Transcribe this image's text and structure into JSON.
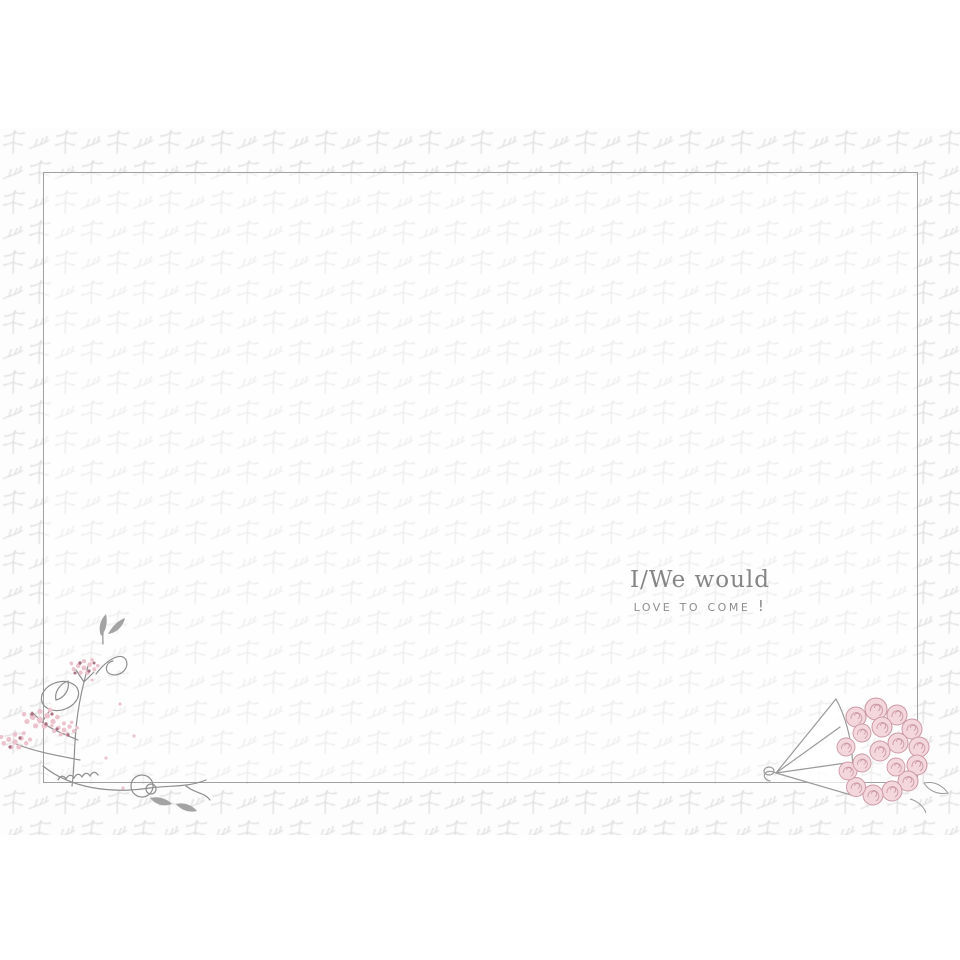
{
  "card": {
    "message": {
      "line1": "I/We would",
      "line2": "love to come !"
    },
    "decorations": [
      {
        "name": "floral-damask-pattern-background",
        "depicts": "pale grey floral sprig pattern band"
      },
      {
        "name": "corner-blossom-illustration",
        "depicts": "pink blossom sprigs with grey swirls over bottom-left frame corner"
      },
      {
        "name": "rose-bouquet-illustration",
        "depicts": "sketched pink rose bouquet in a paper cone over bottom-right frame corner"
      }
    ],
    "colors": {
      "page_background": "#ffffff",
      "pattern_grey": "#d9d9d9",
      "frame_border": "#a1a1a1",
      "text_grey": "#878787",
      "blossom_pink": "#ecc3cd",
      "blossom_dark_pink": "#aa7284",
      "rose_pink": "#f4d7dd",
      "rose_outline": "#cb98a6",
      "stem_grey": "#8f8f8f"
    }
  }
}
